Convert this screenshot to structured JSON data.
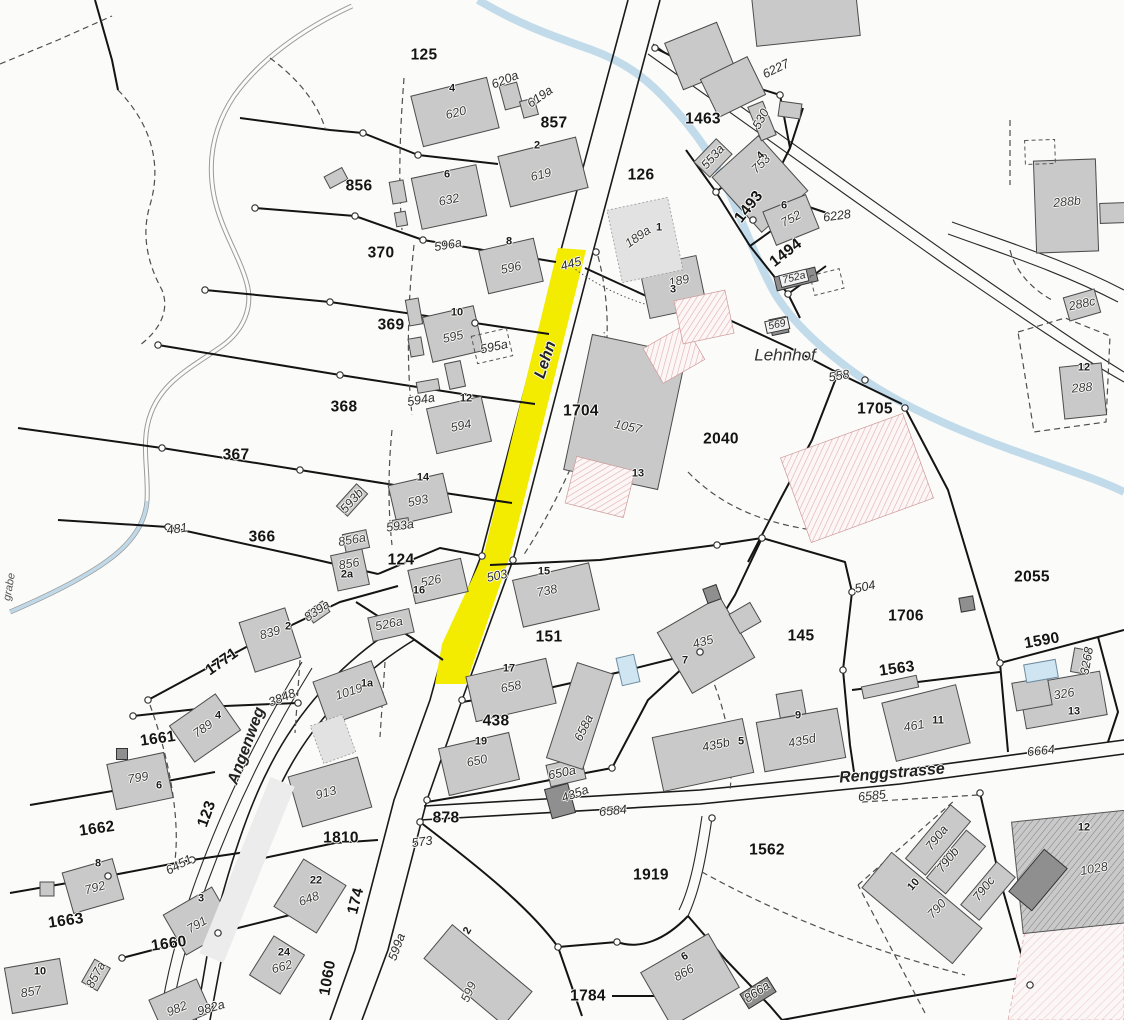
{
  "map": {
    "colors": {
      "highlight": "#f3ec00",
      "building": "#c9c9c9",
      "building_dark": "#8f8f8f",
      "building_light": "#e2e2e2",
      "stream": "#bfd9e9",
      "hatch_pink": "#dfaeae",
      "background": "#fbfbf9",
      "line": "#141414"
    },
    "highlighted_segment": {
      "label": "445",
      "color": "#f3ec00"
    },
    "street_names": [
      [
        "Lehn",
        546,
        360,
        -72
      ],
      [
        "Renggstrasse",
        892,
        774,
        -5
      ],
      [
        "Angenweg",
        247,
        746,
        -70
      ]
    ],
    "place_names": [
      [
        "Lehnhof",
        785,
        355,
        0
      ]
    ],
    "small_names": [
      [
        "grabe",
        10,
        587,
        -80
      ]
    ],
    "parcel_numbers": [
      [
        "125",
        424,
        55
      ],
      [
        "857",
        554,
        123
      ],
      [
        "856",
        359,
        186
      ],
      [
        "370",
        381,
        253
      ],
      [
        "369",
        391,
        325
      ],
      [
        "368",
        344,
        407
      ],
      [
        "367",
        236,
        455
      ],
      [
        "366",
        262,
        537
      ],
      [
        "126",
        641,
        175
      ],
      [
        "1463",
        703,
        119
      ],
      [
        "1493",
        749,
        207,
        -52
      ],
      [
        "1494",
        786,
        253,
        -38
      ],
      [
        "1704",
        581,
        411
      ],
      [
        "2040",
        721,
        439
      ],
      [
        "1705",
        875,
        409
      ],
      [
        "1706",
        906,
        616
      ],
      [
        "2055",
        1032,
        577
      ],
      [
        "1590",
        1042,
        641,
        -10
      ],
      [
        "1563",
        897,
        669,
        -8
      ],
      [
        "145",
        801,
        636
      ],
      [
        "151",
        549,
        637
      ],
      [
        "438",
        496,
        721
      ],
      [
        "124",
        401,
        560
      ],
      [
        "878",
        446,
        818
      ],
      [
        "1771",
        222,
        662,
        -35
      ],
      [
        "1661",
        158,
        739,
        -8
      ],
      [
        "1662",
        97,
        829,
        -8
      ],
      [
        "1663",
        66,
        921,
        -8
      ],
      [
        "1660",
        169,
        944,
        -8
      ],
      [
        "123",
        207,
        814,
        -70
      ],
      [
        "174",
        356,
        901,
        -76
      ],
      [
        "1060",
        328,
        978,
        -80
      ],
      [
        "1810",
        341,
        838
      ],
      [
        "1919",
        651,
        875
      ],
      [
        "1562",
        767,
        850
      ],
      [
        "1784",
        588,
        996
      ]
    ],
    "building_numbers": [
      [
        "620",
        456,
        113,
        -14
      ],
      [
        "619",
        541,
        175,
        -14
      ],
      [
        "632",
        449,
        200,
        -12
      ],
      [
        "596",
        511,
        268,
        -12
      ],
      [
        "595",
        453,
        337,
        -12
      ],
      [
        "594",
        461,
        426,
        -12
      ],
      [
        "593",
        418,
        501,
        -12
      ],
      [
        "526",
        431,
        581,
        -12
      ],
      [
        "526a",
        389,
        624,
        -12
      ],
      [
        "856a",
        352,
        540,
        -10
      ],
      [
        "856",
        349,
        564,
        -10
      ],
      [
        "839",
        270,
        633,
        -16
      ],
      [
        "738",
        547,
        591,
        -12
      ],
      [
        "658",
        511,
        687,
        -12
      ],
      [
        "650",
        477,
        761,
        -12
      ],
      [
        "1019",
        349,
        692,
        -18
      ],
      [
        "913",
        326,
        793,
        -15
      ],
      [
        "789",
        203,
        729,
        -35
      ],
      [
        "799",
        138,
        778,
        -10
      ],
      [
        "792",
        95,
        888,
        -15
      ],
      [
        "791",
        197,
        925,
        -30
      ],
      [
        "857",
        31,
        992,
        -10
      ],
      [
        "982",
        177,
        1009,
        -22
      ],
      [
        "648",
        309,
        899,
        -20
      ],
      [
        "662",
        282,
        967,
        -15
      ],
      [
        "599",
        469,
        992,
        -66
      ],
      [
        "1057",
        628,
        427,
        12
      ],
      [
        "189",
        679,
        281,
        -12
      ],
      [
        "189a",
        638,
        237,
        -35
      ],
      [
        "753",
        761,
        164,
        -45
      ],
      [
        "752",
        791,
        219,
        -28
      ],
      [
        "288b",
        1067,
        202,
        -5
      ],
      [
        "288c",
        1082,
        304,
        -12
      ],
      [
        "288",
        1082,
        388,
        -5
      ],
      [
        "435",
        703,
        642,
        -15
      ],
      [
        "435d",
        802,
        741,
        -12
      ],
      [
        "461",
        914,
        726,
        -10
      ],
      [
        "326",
        1064,
        694,
        -10
      ],
      [
        "790",
        937,
        909,
        -48
      ],
      [
        "1028",
        1094,
        869,
        -10
      ],
      [
        "866",
        684,
        973,
        -30
      ]
    ],
    "house_numbers": [
      [
        "4",
        452,
        89
      ],
      [
        "2",
        537,
        146
      ],
      [
        "6",
        447,
        175
      ],
      [
        "8",
        509,
        242
      ],
      [
        "10",
        457,
        313
      ],
      [
        "12",
        466,
        399
      ],
      [
        "14",
        423,
        478
      ],
      [
        "16",
        419,
        591
      ],
      [
        "2",
        288,
        627
      ],
      [
        "1a",
        367,
        684
      ],
      [
        "15",
        544,
        572
      ],
      [
        "17",
        509,
        669
      ],
      [
        "19",
        481,
        742
      ],
      [
        "2a",
        347,
        575
      ],
      [
        "4",
        218,
        716
      ],
      [
        "6",
        159,
        786
      ],
      [
        "8",
        98,
        864
      ],
      [
        "3",
        201,
        899
      ],
      [
        "10",
        40,
        972
      ],
      [
        "22",
        316,
        881
      ],
      [
        "24",
        284,
        953
      ],
      [
        "2",
        468,
        931,
        -60
      ],
      [
        "13",
        638,
        474
      ],
      [
        "3",
        673,
        290
      ],
      [
        "1",
        659,
        228
      ],
      [
        "4",
        761,
        156,
        -45
      ],
      [
        "6",
        784,
        206
      ],
      [
        "7",
        685,
        661
      ],
      [
        "9",
        798,
        716
      ],
      [
        "11",
        938,
        721
      ],
      [
        "13",
        1074,
        712
      ],
      [
        "5",
        741,
        742
      ],
      [
        "10",
        914,
        885,
        -48
      ],
      [
        "6",
        685,
        957,
        -30
      ],
      [
        "12",
        1084,
        828
      ],
      [
        "12",
        1084,
        368
      ]
    ],
    "point_numbers": [
      [
        "620a",
        505,
        80,
        -22
      ],
      [
        "619a",
        540,
        97,
        -35
      ],
      [
        "6227",
        776,
        69,
        -26
      ],
      [
        "6228",
        837,
        216,
        -8
      ],
      [
        "596a",
        448,
        245,
        -10
      ],
      [
        "595a",
        494,
        347,
        -12
      ],
      [
        "594a",
        421,
        400,
        -10
      ],
      [
        "593a",
        400,
        526,
        -8
      ],
      [
        "593b",
        352,
        501,
        -48
      ],
      [
        "553a",
        713,
        157,
        -48
      ],
      [
        "530",
        761,
        119,
        -62
      ],
      [
        "445",
        571,
        264,
        -15
      ],
      [
        "503",
        497,
        576,
        -12
      ],
      [
        "481",
        177,
        529,
        -8
      ],
      [
        "504",
        865,
        587,
        -12
      ],
      [
        "558",
        839,
        376,
        -10
      ],
      [
        "573",
        422,
        842,
        -8
      ],
      [
        "3848",
        282,
        698,
        -22
      ],
      [
        "6451",
        179,
        865,
        -28
      ],
      [
        "6584",
        613,
        811,
        -6
      ],
      [
        "6585",
        872,
        796,
        -6
      ],
      [
        "6664",
        1041,
        751,
        -6
      ],
      [
        "3268",
        1087,
        661,
        -80
      ],
      [
        "839a",
        317,
        611,
        -34
      ],
      [
        "599a",
        397,
        947,
        -70
      ],
      [
        "650a",
        562,
        773,
        -12
      ],
      [
        "435a",
        575,
        794,
        -20
      ],
      [
        "658a",
        584,
        728,
        -64
      ],
      [
        "866a",
        757,
        992,
        -34
      ],
      [
        "857a",
        96,
        975,
        -62
      ],
      [
        "982a",
        211,
        1008,
        -16
      ],
      [
        "435b",
        716,
        745,
        -12
      ],
      [
        "790a",
        937,
        838,
        -52
      ],
      [
        "790b",
        948,
        860,
        -52
      ],
      [
        "790c",
        984,
        889,
        -52
      ]
    ],
    "boxed_numbers": [
      [
        "569",
        777,
        325,
        -12
      ],
      [
        "752a",
        794,
        278,
        -14
      ]
    ]
  }
}
